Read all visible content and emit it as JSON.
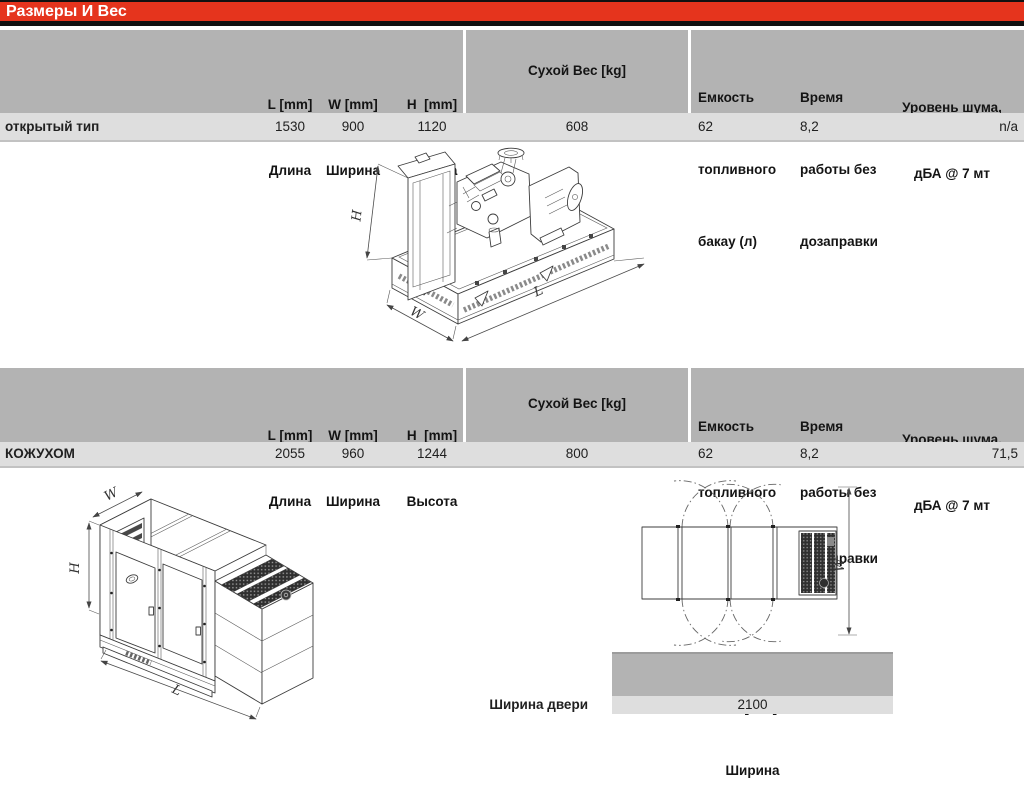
{
  "title": "Размеры И Вес",
  "colors": {
    "accent_red": "#e5341d",
    "header_gray": "#b3b3b3",
    "row_gray": "#dedede"
  },
  "tables": {
    "open": {
      "headers": {
        "l": [
          "L [mm]",
          "Длина"
        ],
        "w": [
          "W [mm]",
          "Ширина"
        ],
        "h": [
          "H  [mm]",
          "Высота"
        ],
        "dry": "Сухой Вес [kg]",
        "fuel": [
          "Емкость",
          "топливного",
          "бакау (л)"
        ],
        "runtime": [
          "Время",
          "работы без",
          "дозаправки"
        ],
        "noise": [
          "Уровень шума,",
          "дБА @ 7 мт"
        ]
      },
      "row": {
        "label": "открытый тип",
        "l": "1530",
        "w": "900",
        "h": "1120",
        "dry": "608",
        "fuel": "62",
        "runtime": "8,2",
        "noise": "n/a"
      }
    },
    "canopy": {
      "headers": {
        "l": [
          "L [mm]",
          "Длина"
        ],
        "w": [
          "W [mm]",
          "Ширина"
        ],
        "h": [
          "H  [mm]",
          "Высота"
        ],
        "dry": "Сухой Вес [kg]",
        "fuel": [
          "Емкость",
          "топливного",
          "бака (л)"
        ],
        "runtime": [
          "Время",
          "работы без",
          "дозаправки"
        ],
        "noise": [
          "Уровень шума,",
          "дБА @ 7 мт"
        ]
      },
      "row": {
        "label": "КОЖУХОМ",
        "l": "2055",
        "w": "960",
        "h": "1244",
        "dry": "800",
        "fuel": "62",
        "runtime": "8,2",
        "noise": "71,5"
      }
    }
  },
  "dim_labels": {
    "h": "H",
    "w": "W",
    "l": "L"
  },
  "door_table": {
    "headers": [
      "W [mm]",
      "Ширина"
    ],
    "row_label": "Ширина двери",
    "value": "2100"
  }
}
